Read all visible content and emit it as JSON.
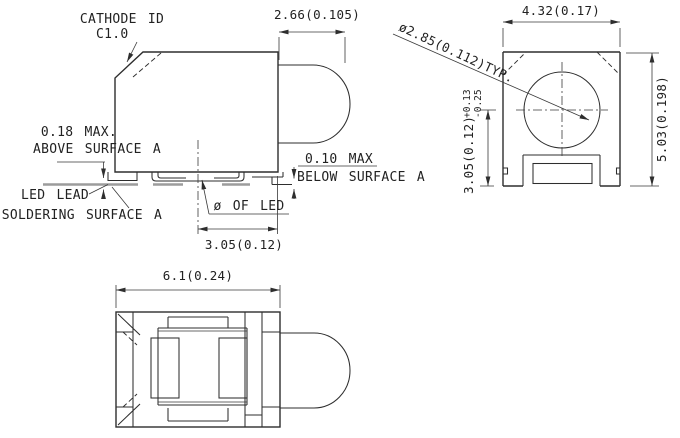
{
  "labels": {
    "cathode_id": "CATHODE ID",
    "cathode_mark": "C1.0",
    "above_max": "0.18 MAX.",
    "above_surface": "ABOVE SURFACE A",
    "led_lead": "LED LEAD",
    "soldering_surface": "SOLDERING SURFACE A",
    "below_max": "0.10 MAX",
    "below_surface": "BELOW SURFACE A",
    "led_diameter_ref": "ø OF LED"
  },
  "dimensions": {
    "lens_protrusion": "2.66(0.105)",
    "center_to_face": "3.05(0.12)",
    "body_width_bottom_view": "6.1(0.24)",
    "side_width": "4.32(0.17)",
    "lens_diameter": "ø2.85(0.112)TYP.",
    "side_height": "5.03(0.198)",
    "axis_height": "3.05(0.12)",
    "axis_height_tol_plus": "+0.13",
    "axis_height_tol_minus": "-0.25"
  },
  "colors": {
    "line": "#2e2e2e",
    "soldering_surface_gray": "#9c9c9c",
    "background": "#ffffff"
  }
}
